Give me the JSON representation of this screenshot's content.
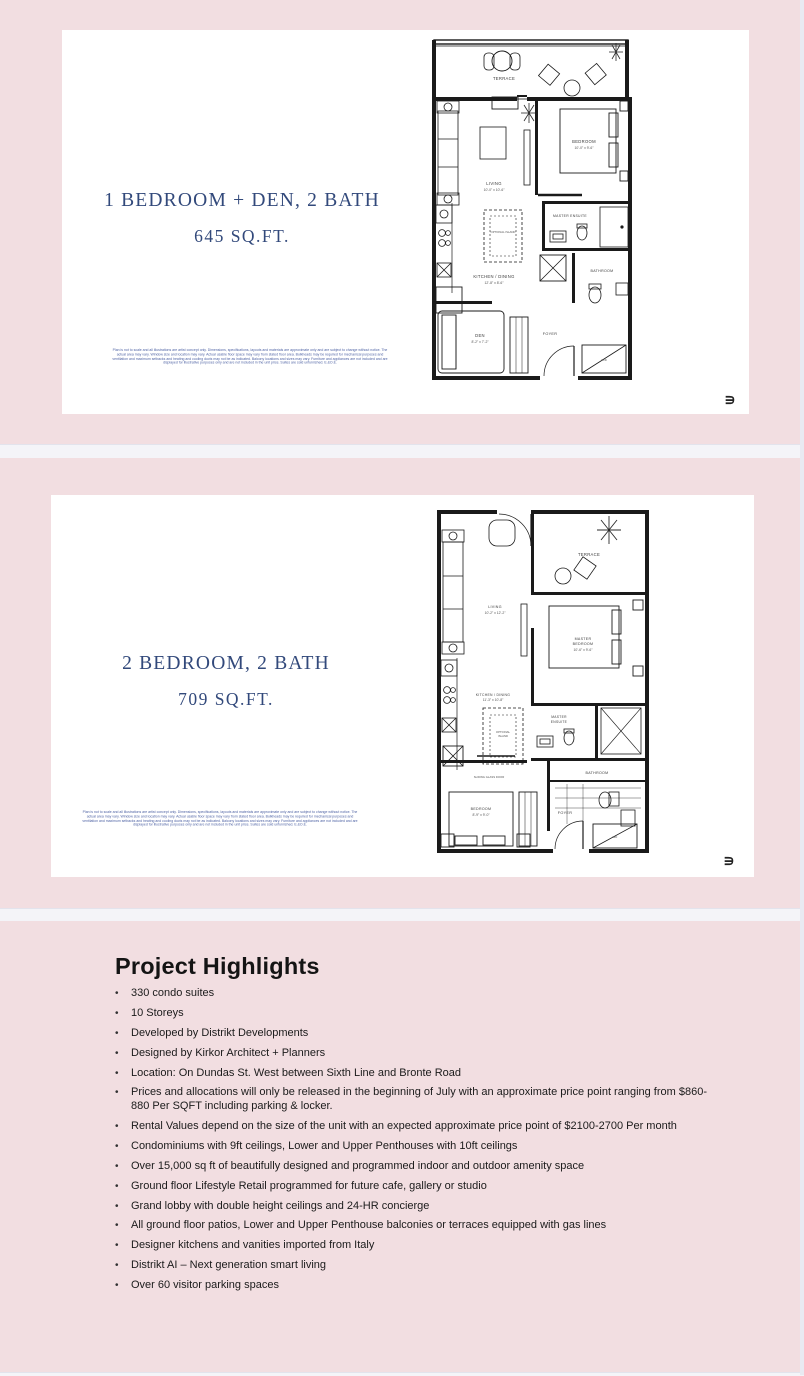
{
  "colors": {
    "page_bg": "#f2dee1",
    "card_bg": "#ffffff",
    "accent_navy": "#32497b",
    "disclaimer_blue": "#4f63a4",
    "body_text": "#1b1b1b",
    "separator": "#f4f4f8",
    "edge_strip": "#e9eaf2",
    "plan_ink": "#1a1a1a"
  },
  "slides": [
    {
      "title": "1 BEDROOM + DEN, 2 BATH",
      "subtitle": "645 SQ.FT.",
      "logo_glyph": "∍",
      "disclaimer": "Plan is not to scale and all illustrations are artist concept only. Dimensions, specifications, layouts and materials are approximate only and are subject to change without notice. The actual area may vary. Window size and location may vary. Actual usable floor space may vary from stated floor area. Bulkheads may be required for mechanical purposes and ventilation and maximum setbacks and heating and cooling ducts may not be as indicated. Balcony locations and sizes may vary. Furniture and appliances are not included and are displayed for illustrative purposes only and are not included in the unit price. Suites are sold unfurnished. E.&O.E.",
      "plan": {
        "terrace": "TERRACE",
        "bedroom": "BEDROOM",
        "bedroom_dims": "10'-0\" x 9'-6\"",
        "living": "LIVING",
        "living_dims": "10'-0\" x 10'-6\"",
        "kitchen": "KITCHEN / DINING",
        "kitchen_dims": "12'-8\" x 8'-6\"",
        "island": "OPTIONAL ISLAND",
        "ensuite": "MASTER ENSUITE",
        "bathroom": "BATHROOM",
        "den": "DEN",
        "den_dims": "8'-2\" x 7'-2\"",
        "foyer": "FOYER",
        "wd": "W/D"
      }
    },
    {
      "title": "2 BEDROOM, 2 BATH",
      "subtitle": "709 SQ.FT.",
      "logo_glyph": "∍",
      "disclaimer": "Plan is not to scale and all illustrations are artist concept only. Dimensions, specifications, layouts and materials are approximate only and are subject to change without notice. The actual area may vary. Window size and location may vary. Actual usable floor space may vary from stated floor area. Bulkheads may be required for mechanical purposes and ventilation and maximum setbacks and heating and cooling ducts may not be as indicated. Balcony locations and sizes may vary. Furniture and appliances are not included and are displayed for illustrative purposes only and are not included in the unit price. Suites are sold unfurnished. E.&O.E.",
      "plan": {
        "terrace": "TERRACE",
        "living": "LIVING",
        "living_dims": "10'-2\" x 12'-2\"",
        "master_bedroom_1": "MASTER",
        "master_bedroom_2": "BEDROOM",
        "master_bedroom_dims": "10'-6\" x 9'-6\"",
        "kitchen": "KITCHEN / DINING",
        "kitchen_dims": "11'-3\" x 10'-8\"",
        "island_1": "OPTIONAL",
        "island_2": "ISLAND",
        "ensuite_1": "MASTER",
        "ensuite_2": "ENSUITE",
        "bathroom": "BATHROOM",
        "bedroom": "BEDROOM",
        "bedroom_dims": "8'-9\" x 9'-0\"",
        "sliding_door": "SLIDING GLASS DOOR",
        "foyer": "FOYER",
        "wd": "WD"
      }
    }
  ],
  "highlights": {
    "title": "Project Highlights",
    "bullet_glyph": "•",
    "bullets": [
      "330 condo suites",
      "10 Storeys",
      "Developed by Distrikt Developments",
      "Designed by Kirkor Architect + Planners",
      "Location: On Dundas St. West between Sixth Line and Bronte Road",
      "Prices and allocations will only be released in the beginning of July with an approximate price point ranging from $860-880 Per SQFT including parking & locker.",
      "Rental Values depend on the size of the unit with an expected approximate price point of $2100-2700 Per month",
      "Condominiums with 9ft ceilings, Lower and Upper Penthouses with 10ft ceilings",
      "Over 15,000 sq ft of beautifully designed and programmed indoor and outdoor amenity space",
      "Ground floor Lifestyle Retail programmed for future cafe, gallery or studio",
      "Grand lobby with double height ceilings and 24-HR concierge",
      "All ground floor patios, Lower and Upper Penthouse balconies or terraces equipped with gas lines",
      "Designer kitchens and vanities imported from Italy",
      "Distrikt AI – Next generation smart living",
      "Over 60 visitor parking spaces"
    ]
  }
}
